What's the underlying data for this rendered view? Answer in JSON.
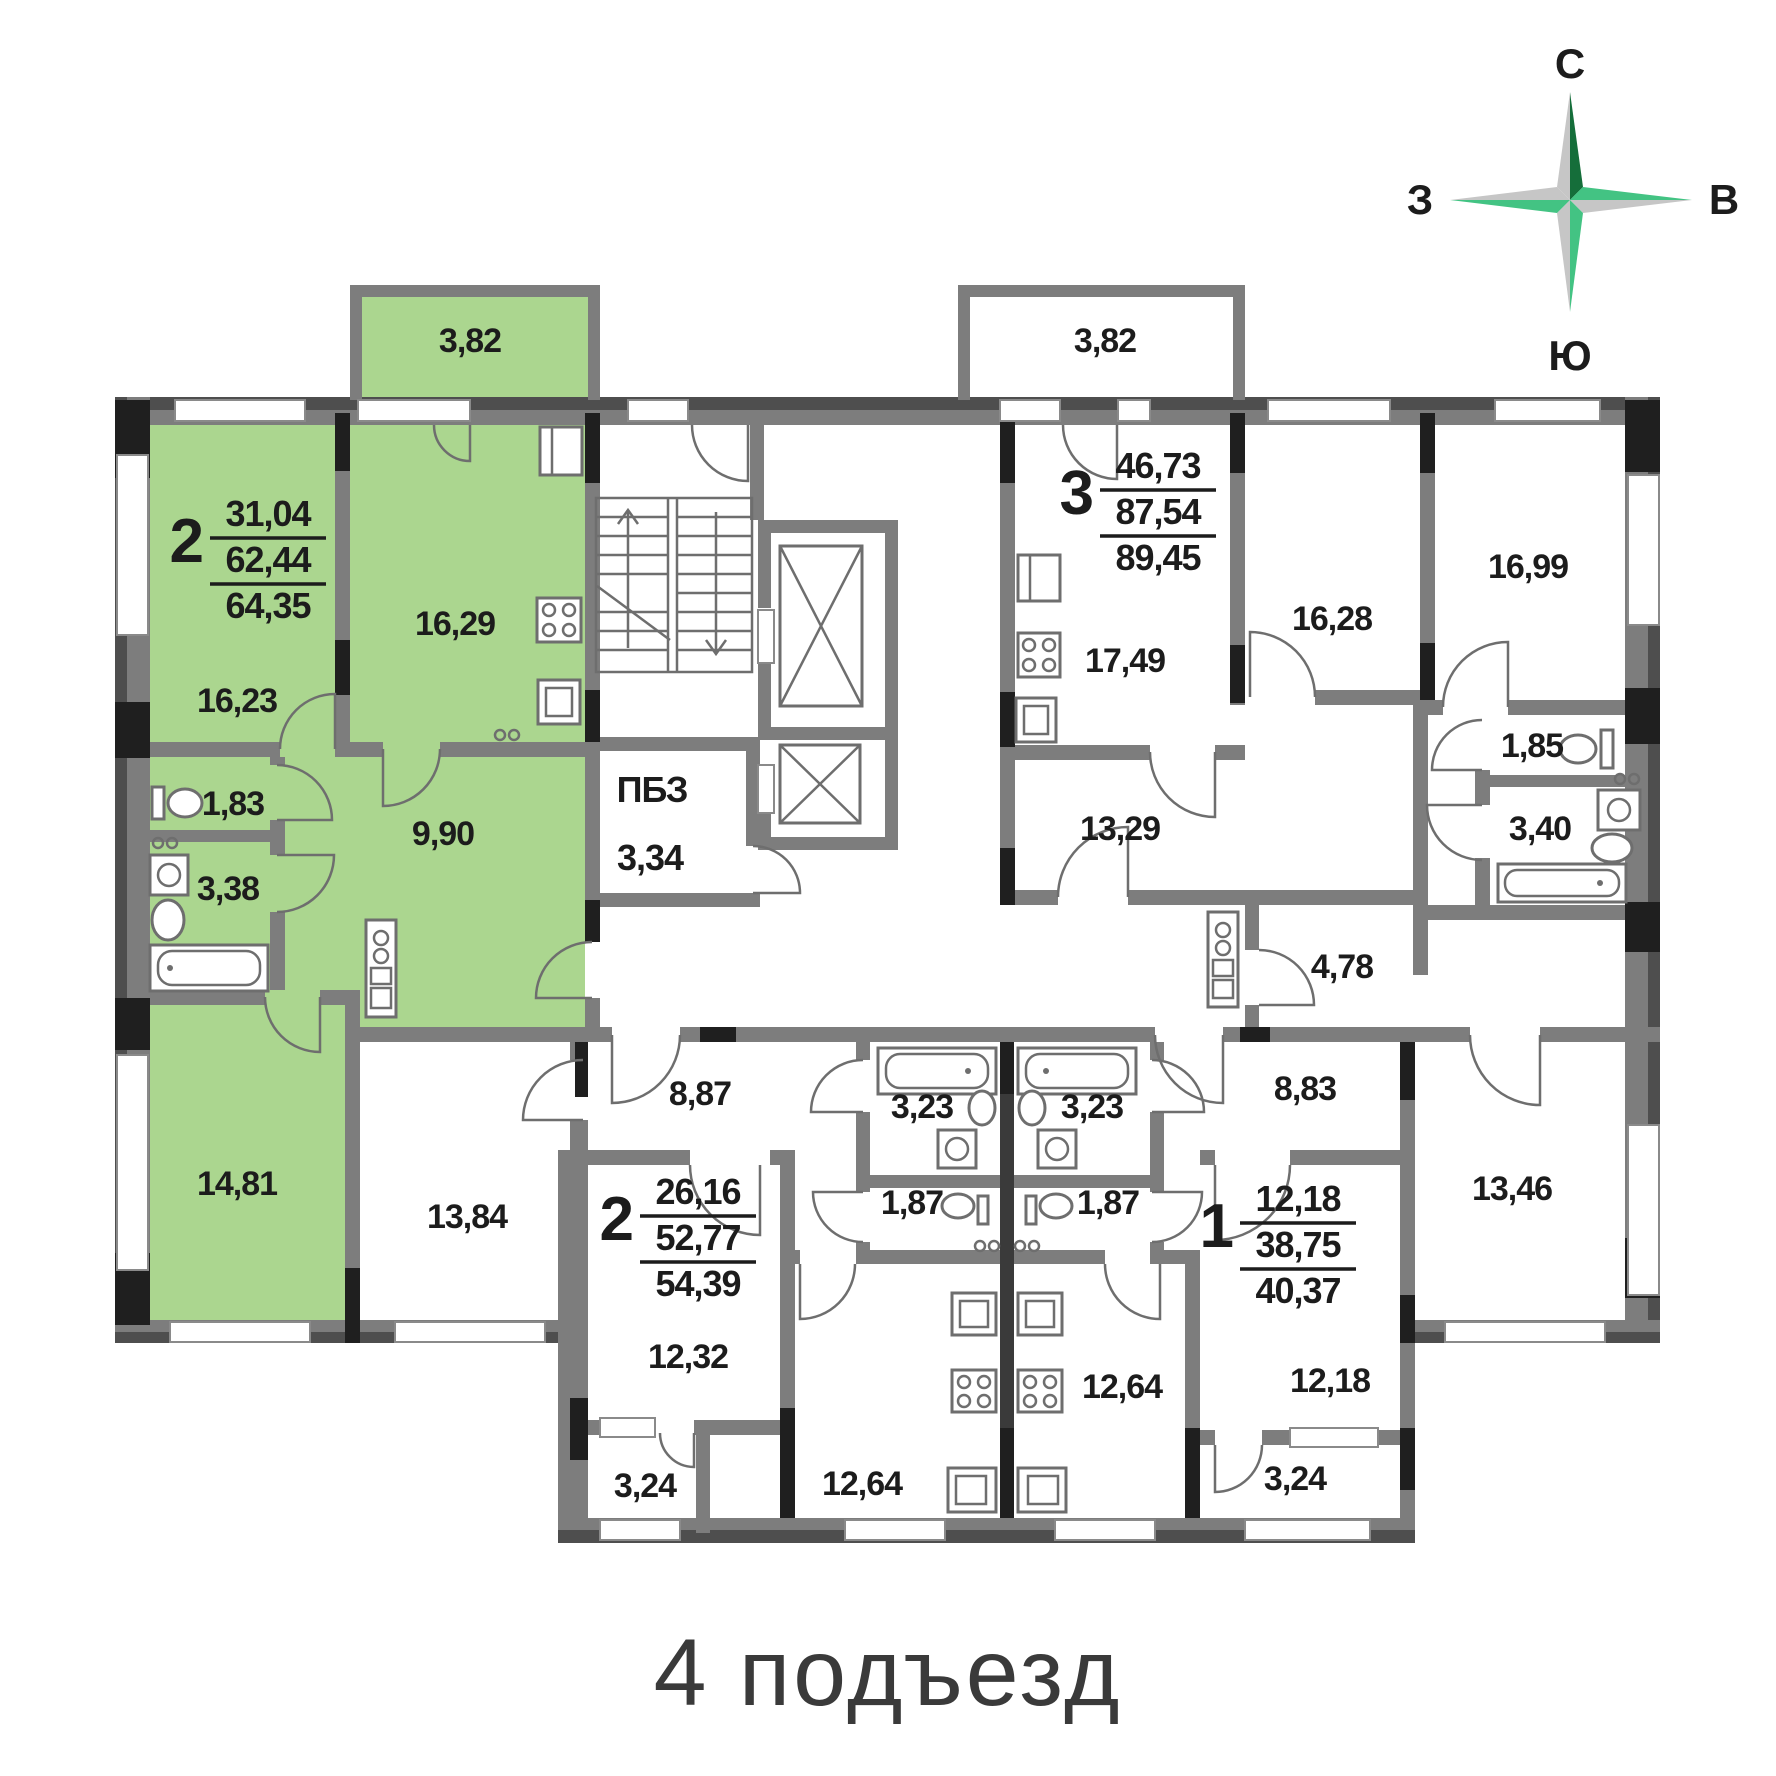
{
  "title": "4 подъезд",
  "compass": {
    "north": "С",
    "east": "В",
    "south": "Ю",
    "west": "З"
  },
  "colors": {
    "highlight_green": "#abd68f",
    "wall_gray": "#7d7d7d",
    "wall_dark": "#4e4e4e",
    "pier_black": "#1f1f1f",
    "compass_dark_green": "#156e3a",
    "compass_green": "#43c383",
    "compass_gray": "#c6c6c6",
    "label_color": "#1c1c1c"
  },
  "apartments": [
    {
      "rooms": "2",
      "living_area": "31,04",
      "apartment_area": "62,44",
      "total_area": "64,35",
      "highlighted": true
    },
    {
      "rooms": "3",
      "living_area": "46,73",
      "apartment_area": "87,54",
      "total_area": "89,45",
      "highlighted": false
    },
    {
      "rooms": "2",
      "living_area": "26,16",
      "apartment_area": "52,77",
      "total_area": "54,39",
      "highlighted": false
    },
    {
      "rooms": "1",
      "living_area": "12,18",
      "apartment_area": "38,75",
      "total_area": "40,37",
      "highlighted": false
    }
  ],
  "tech_room": {
    "name": "ПБЗ",
    "area": "3,34"
  },
  "room_areas": [
    {
      "name": "balcony-green",
      "area": "3,82"
    },
    {
      "name": "room-green",
      "area": "16,23"
    },
    {
      "name": "kitchen-green",
      "area": "16,29"
    },
    {
      "name": "wc-green",
      "area": "1,83"
    },
    {
      "name": "bath-green",
      "area": "3,38"
    },
    {
      "name": "hall-green",
      "area": "9,90"
    },
    {
      "name": "room2-green",
      "area": "14,81"
    },
    {
      "name": "balcony-apt3",
      "area": "3,82"
    },
    {
      "name": "kitchen-apt3",
      "area": "17,49"
    },
    {
      "name": "room1-apt3",
      "area": "16,28"
    },
    {
      "name": "room2-apt3",
      "area": "16,99"
    },
    {
      "name": "hall-apt3",
      "area": "13,29"
    },
    {
      "name": "wc-apt3",
      "area": "1,85"
    },
    {
      "name": "bath-apt3",
      "area": "3,40"
    },
    {
      "name": "storage-apt3",
      "area": "4,78"
    },
    {
      "name": "room1-apt2b",
      "area": "13,84"
    },
    {
      "name": "hall-apt2b",
      "area": "8,87"
    },
    {
      "name": "room2-apt2b",
      "area": "12,32"
    },
    {
      "name": "balcony-apt2b",
      "area": "3,24"
    },
    {
      "name": "bath-apt2b",
      "area": "3,23"
    },
    {
      "name": "wc-apt2b",
      "area": "1,87"
    },
    {
      "name": "kitchen-apt2b",
      "area": "12,64"
    },
    {
      "name": "bath-apt1",
      "area": "3,23"
    },
    {
      "name": "wc-apt1",
      "area": "1,87"
    },
    {
      "name": "kitchen-apt1",
      "area": "12,64"
    },
    {
      "name": "hall-apt1",
      "area": "8,83"
    },
    {
      "name": "room-apt1",
      "area": "12,18"
    },
    {
      "name": "balcony-apt1",
      "area": "3,24"
    },
    {
      "name": "room2-apt1",
      "area": "13,46"
    }
  ]
}
